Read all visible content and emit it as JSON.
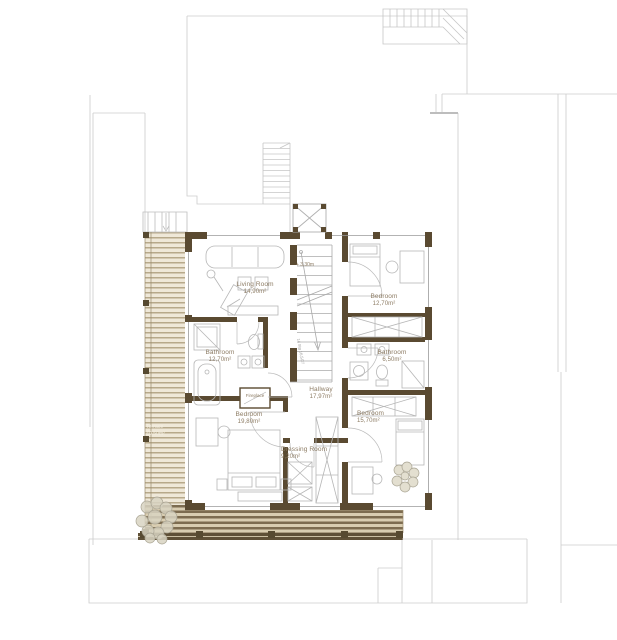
{
  "plan": {
    "type": "architectural floor plan",
    "colors": {
      "wall": "#5a4a31",
      "context_line": "#cccccc",
      "furniture_line": "#b6b6b6",
      "label_text": "#8d7c64",
      "terrace_stripe_dark": "#7d6c50",
      "terrace_stripe_light": "#efe8d8",
      "terrace_edge_band": "#5f5037",
      "plant_fill": "#e3dfd0"
    },
    "rooms": [
      {
        "name": "Living Room",
        "area": "14,90m²"
      },
      {
        "name": "Bedroom",
        "area": "12,70m²"
      },
      {
        "name": "Bathroom",
        "area": "12,70m²"
      },
      {
        "name": "Bathroom",
        "area": "6,50m²"
      },
      {
        "name": "Hallway",
        "area": "17,97m²"
      },
      {
        "name": "Bedroom",
        "area": "19,80m²"
      },
      {
        "name": "Dressing Room",
        "area": "9,20m²"
      },
      {
        "name": "Bedroom",
        "area": "15,70m²"
      },
      {
        "name": "Terrace",
        "area": "40,50m²"
      }
    ],
    "annotations": {
      "level_marker": "+ 3,30m",
      "stair_note": "14 Stg 16,5/27",
      "fireplace": "Fireplace"
    }
  }
}
